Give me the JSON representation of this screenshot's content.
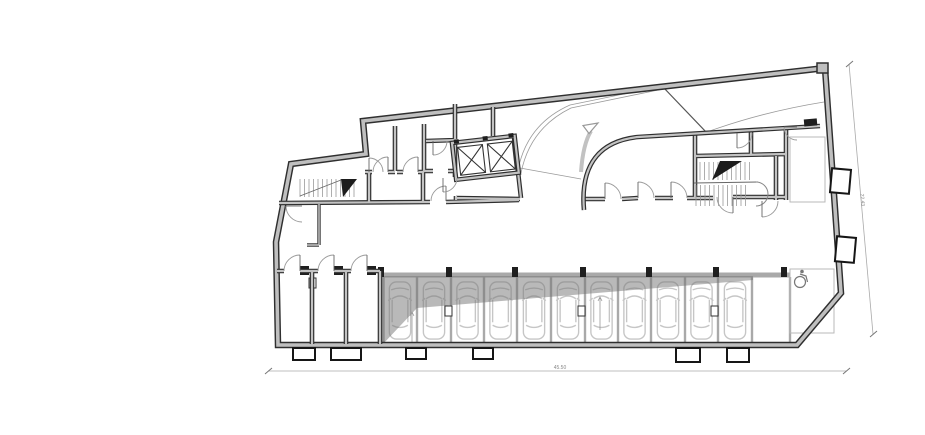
{
  "drawing": {
    "type": "architectural floor plan",
    "view": "garage / basement parking level"
  },
  "dimensions": {
    "bottom_label": "45.50",
    "right_label": "22.43"
  },
  "parking": {
    "car_count": 11,
    "storage_room_count": 3,
    "accessible_stall_count": 1
  },
  "features": {
    "elevator_count": 2,
    "stair_count": 2,
    "ramp": "curved vehicle ramp with direction arrow"
  },
  "colors": {
    "background": "#ffffff",
    "wall_edge": "#2f2f2f",
    "wall_fill": "#bfbfbf",
    "stall_wall": "#a9a9a9",
    "car_line": "#c6c6c6",
    "shade_overlay": "rgba(115,115,115,0.5)",
    "dimension": "#8a8a8a"
  },
  "icons": [
    {
      "name": "accessible-parking-icon",
      "glyph": "wheelchair"
    },
    {
      "name": "ramp-arrow-icon",
      "glyph": "curved arrow"
    },
    {
      "name": "elevator-x-icon",
      "glyph": "crossed box"
    }
  ]
}
